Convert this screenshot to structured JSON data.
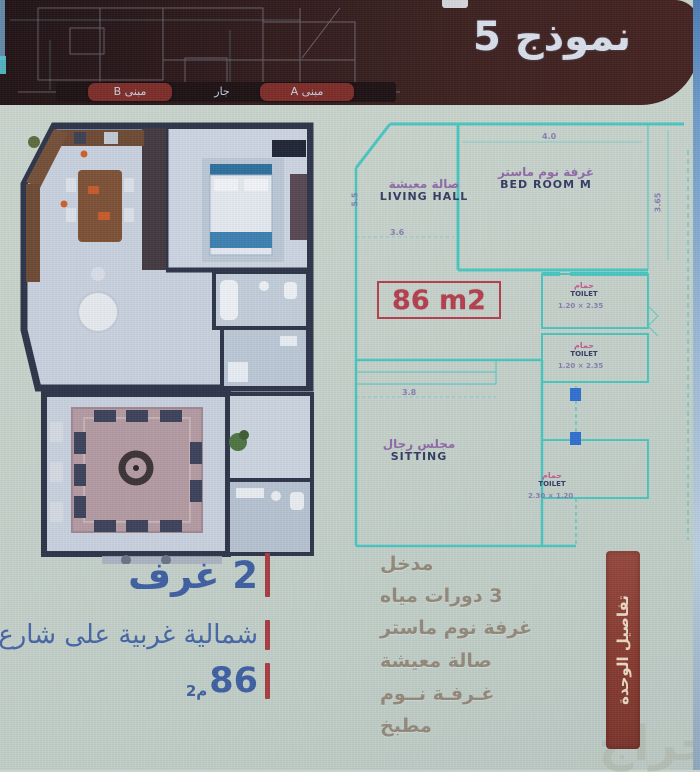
{
  "banner": {
    "title": "نموذج 5",
    "tabs": [
      {
        "label": "مبنى B"
      },
      {
        "label": "جار"
      },
      {
        "label": "مبنى A"
      }
    ]
  },
  "plan2d": {
    "area_label": "86 m2",
    "rooms": {
      "living": {
        "ar": "صالة معيشة",
        "en": "LIVING HALL"
      },
      "master": {
        "ar": "غرفة نوم ماستر",
        "en": "BED ROOM M"
      },
      "sitting": {
        "ar": "مجلس رجال",
        "en": "SITTING"
      },
      "toilet": {
        "ar": "حمام",
        "en": "TOILET"
      }
    },
    "dims": {
      "bed_w": "4.0",
      "bed_h": "3.65",
      "living_w": "3.6",
      "mid": "3.8",
      "left": "5.5",
      "toilet1": "1.20 × 2.35",
      "toilet2": "1.20 × 2.35",
      "toilet3": "2.30 × 1.20"
    }
  },
  "specs": {
    "rooms_label": "2 غرف",
    "orientation": "شمالية غربية على شارع",
    "area_value": "86",
    "area_unit": "م2"
  },
  "details": {
    "ribbon": "تفاصيل الوحدة",
    "items": [
      "مدخل",
      "3 دورات مياه",
      "غرفة نوم ماستر",
      "صالة معيشة",
      "غـرفـة نــوم",
      "مطبخ"
    ]
  },
  "watermark": "حراج",
  "colors": {
    "banner": "#3a201e",
    "tab_bg": "#7c2b27",
    "plan_line": "#49c6c0",
    "accent_red": "#b43d4d",
    "spec_blue": "#3e5ea2",
    "ribbon": "#8a3c33"
  }
}
